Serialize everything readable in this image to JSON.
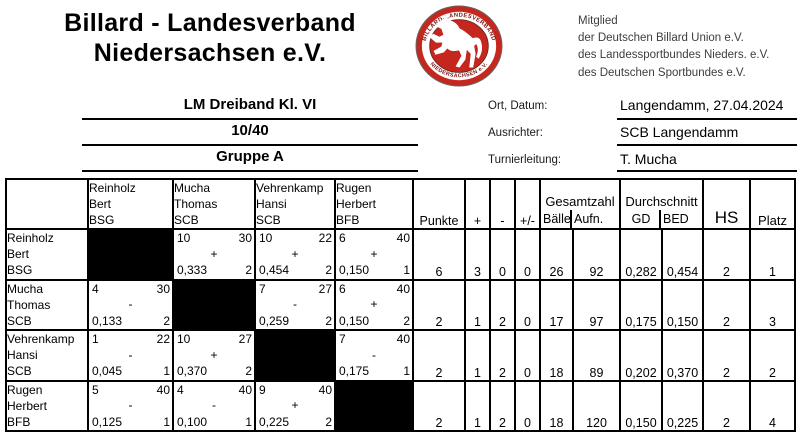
{
  "colors": {
    "logo_red": "#c5261d",
    "logo_ring_text": "#7a1512",
    "membership_text": "#3d3d3d"
  },
  "header": {
    "title_line1": "Billard - Landesverband",
    "title_line2": "Niedersachsen e.V."
  },
  "logo": {
    "ring_top": "BILLARD-LANDESVERBAND",
    "ring_bottom": "NIEDERSACHSEN e.V."
  },
  "membership": [
    "Mitglied",
    "der Deutschen Billard Union e.V.",
    "des Landessportbundes Nieders. e.V.",
    "des Deutschen Sportbundes e.V."
  ],
  "event": {
    "title": "LM Dreiband Kl. VI",
    "mode": "10/40",
    "group": "Gruppe A",
    "fields": [
      {
        "label": "Ort, Datum:",
        "value": "Langendamm, 27.04.2024"
      },
      {
        "label": "Ausrichter:",
        "value": "SCB Langendamm"
      },
      {
        "label": "Turnierleitung:",
        "value": "T. Mucha"
      }
    ]
  },
  "table": {
    "headers": {
      "punkte": "Punkte",
      "plus": "+",
      "minus": "-",
      "plusminus": "+/-",
      "gesamtzahl": "Gesamtzahl",
      "baelle": "Bälle",
      "aufn": "Aufn.",
      "durchschnitt": "Durchschnitt",
      "gd": "GD",
      "bed": "BED",
      "hs": "HS",
      "platz": "Platz"
    },
    "players": [
      {
        "name": "Reinholz",
        "first": "Bert",
        "club": "BSG"
      },
      {
        "name": "Mucha",
        "first": "Thomas",
        "club": "SCB"
      },
      {
        "name": "Vehrenkamp",
        "first": "Hansi",
        "club": "SCB"
      },
      {
        "name": "Rugen",
        "first": "Herbert",
        "club": "BFB"
      }
    ],
    "rows": [
      {
        "matches": [
          null,
          {
            "balls": "10",
            "inn": "30",
            "sign": "+",
            "avg": "0,333",
            "hs": "2"
          },
          {
            "balls": "10",
            "inn": "22",
            "sign": "+",
            "avg": "0,454",
            "hs": "2"
          },
          {
            "balls": "6",
            "inn": "40",
            "sign": "+",
            "avg": "0,150",
            "hs": "1"
          }
        ],
        "totals": {
          "punkte": "6",
          "plus": "3",
          "minus": "0",
          "pm": "0",
          "baelle": "26",
          "aufn": "92",
          "gd": "0,282",
          "bed": "0,454",
          "hs": "2",
          "platz": "1"
        }
      },
      {
        "matches": [
          {
            "balls": "4",
            "inn": "30",
            "sign": "-",
            "avg": "0,133",
            "hs": "2"
          },
          null,
          {
            "balls": "7",
            "inn": "27",
            "sign": "-",
            "avg": "0,259",
            "hs": "2"
          },
          {
            "balls": "6",
            "inn": "40",
            "sign": "+",
            "avg": "0,150",
            "hs": "2"
          }
        ],
        "totals": {
          "punkte": "2",
          "plus": "1",
          "minus": "2",
          "pm": "0",
          "baelle": "17",
          "aufn": "97",
          "gd": "0,175",
          "bed": "0,150",
          "hs": "2",
          "platz": "3"
        }
      },
      {
        "matches": [
          {
            "balls": "1",
            "inn": "22",
            "sign": "-",
            "avg": "0,045",
            "hs": "1"
          },
          {
            "balls": "10",
            "inn": "27",
            "sign": "+",
            "avg": "0,370",
            "hs": "2"
          },
          null,
          {
            "balls": "7",
            "inn": "40",
            "sign": "-",
            "avg": "0,175",
            "hs": "1"
          }
        ],
        "totals": {
          "punkte": "2",
          "plus": "1",
          "minus": "2",
          "pm": "0",
          "baelle": "18",
          "aufn": "89",
          "gd": "0,202",
          "bed": "0,370",
          "hs": "2",
          "platz": "2"
        }
      },
      {
        "matches": [
          {
            "balls": "5",
            "inn": "40",
            "sign": "-",
            "avg": "0,125",
            "hs": "1"
          },
          {
            "balls": "4",
            "inn": "40",
            "sign": "-",
            "avg": "0,100",
            "hs": "1"
          },
          {
            "balls": "9",
            "inn": "40",
            "sign": "+",
            "avg": "0,225",
            "hs": "2"
          },
          null
        ],
        "totals": {
          "punkte": "2",
          "plus": "1",
          "minus": "2",
          "pm": "0",
          "baelle": "18",
          "aufn": "120",
          "gd": "0,150",
          "bed": "0,225",
          "hs": "2",
          "platz": "4"
        }
      }
    ]
  }
}
